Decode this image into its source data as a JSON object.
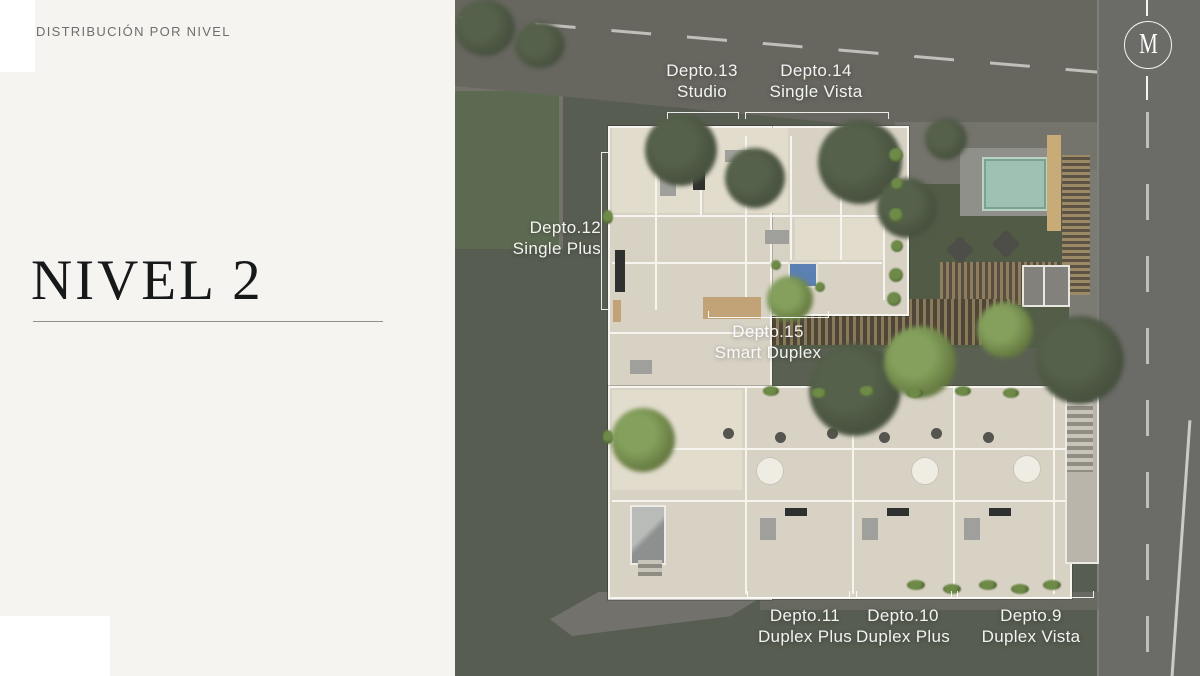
{
  "slide": {
    "kicker": "DISTRIBUCIÓN POR NIVEL",
    "title": "NIVEL 2",
    "logo_letter": "M"
  },
  "floorplan": {
    "units": [
      {
        "name": "Depto.13",
        "type": "Studio"
      },
      {
        "name": "Depto.14",
        "type": "Single Vista"
      },
      {
        "name": "Depto.12",
        "type": "Single Plus"
      },
      {
        "name": "Depto.15",
        "type": "Smart Duplex"
      },
      {
        "name": "Depto.11",
        "type": "Duplex Plus"
      },
      {
        "name": "Depto.10",
        "type": "Duplex Plus"
      },
      {
        "name": "Depto.9",
        "type": "Duplex Vista"
      }
    ]
  },
  "colors": {
    "slide_background": "#f5f4f0",
    "terrain_green": "#575d50",
    "lawn_green": "#5d6a52",
    "road_gray": "#6b6b67",
    "building_floor": "#d8d2c5",
    "pool_teal": "#9fc1b3",
    "wood_deck": "#8a7a5a",
    "label_text": "#ffffff",
    "title_text": "#17181a"
  }
}
